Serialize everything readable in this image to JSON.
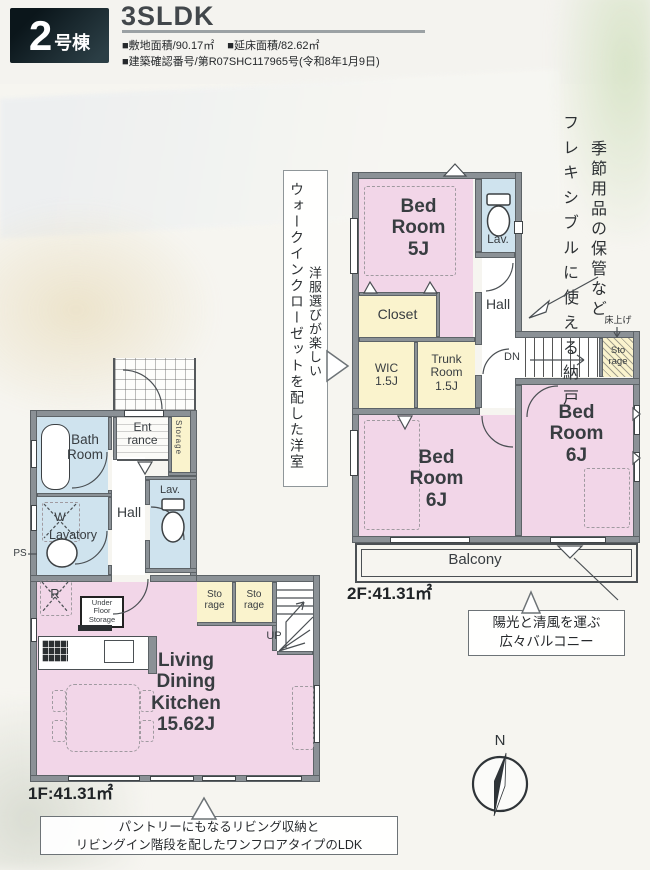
{
  "header": {
    "badge_number": "2",
    "badge_suffix": "号棟",
    "plan_type": "3SLDK",
    "spec_site": "■敷地面積/90.17㎡",
    "spec_floor": "■延床面積/82.62㎡",
    "spec_permit": "■建築確認番号/第R07SHC117965号(令和8年1月9日)"
  },
  "annotations": {
    "wic_note_line1": "洋服選びが楽しい",
    "wic_note_line2": "ウォークインクローゼットを配した洋室",
    "storage_note_line1": "季節用品の保管など",
    "storage_note_line2": "フレキシブルに使える納戸",
    "floor_raise": "床上げ",
    "balcony_note": "陽光と清風を運ぶ\n広々バルコニー",
    "ldk_note": "パントリーにもなるリビング収納と\nリビングイン階段を配したワンフロアタイプのLDK"
  },
  "floor2": {
    "area": "2F:41.31㎡",
    "bedroom5": "Bed\nRoom\n5J",
    "lav": "Lav.",
    "closet": "Closet",
    "hall": "Hall",
    "wic": "WIC\n1.5J",
    "trunk": "Trunk\nRoom\n1.5J",
    "dn": "DN",
    "storage": "Sto\nrage",
    "bedroom6_left": "Bed\nRoom\n6J",
    "bedroom6_right": "Bed\nRoom\n6J",
    "balcony": "Balcony"
  },
  "floor1": {
    "area": "1F:41.31㎡",
    "bath": "Bath\nRoom",
    "entrance": "Ent\nrance",
    "entrance_storage": "Storage",
    "lav": "Lav.",
    "washer": "W",
    "lavatory": "Lavatory",
    "hall": "Hall",
    "ps": "PS",
    "fridge": "R",
    "under_floor": "Under\nFloor\nStorage",
    "storage1": "Sto\nrage",
    "storage2": "Sto\nrage",
    "up": "UP",
    "ldk": "Living\nDining\nKitchen\n15.62J"
  },
  "compass": {
    "north": "N"
  },
  "colors": {
    "pink": "#f2d6e8",
    "yellow": "#faf3cd",
    "blue": "#cfe3ee",
    "wall": "#8b9196"
  }
}
